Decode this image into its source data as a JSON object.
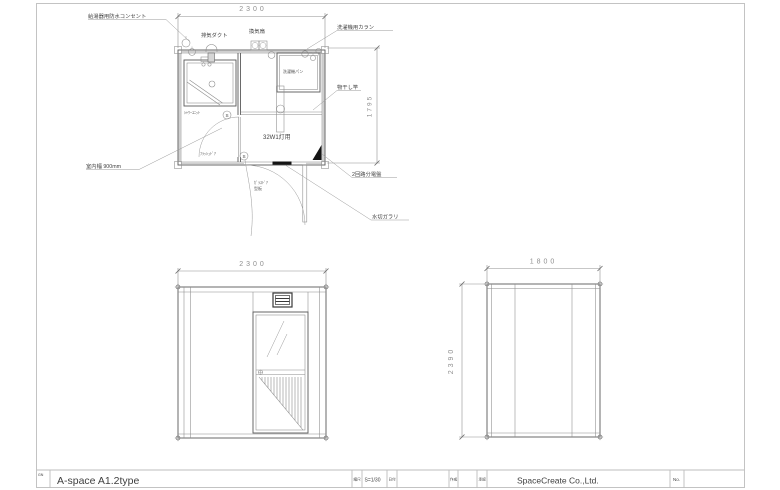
{
  "title_block": {
    "corner_code": "GN",
    "drawing_title": "A-space A1.2type",
    "scale_label": "縮尺",
    "scale_value": "S=1/30",
    "date_label": "日付",
    "drawn_label": "作成",
    "approved_label": "承認",
    "number_label": "No.",
    "company": "SpaceCreate Co.,Ltd."
  },
  "floor_plan": {
    "dim_width": "2300",
    "dim_depth": "1795",
    "labels": {
      "water_heater_outlet": "給湯器用防水コンセント",
      "exhaust_duct": "排気ダクト",
      "vent_fan": "換気扇",
      "washer_faucet": "洗濯機用カラン",
      "washer_pan": "洗濯機パン",
      "drying_pole": "物干し竿",
      "distribution_board": "2回路分電盤",
      "drip_louver": "水切ガラリ",
      "interior_width": "室内幅 900mm",
      "shower_unit": "ｼｬﾜｰﾕﾆｯﾄ",
      "flush_door": "ﾌﾗｯｼｭﾄﾞｱ",
      "glass_door": "ｶﾞﾗｽﾄﾞｱ",
      "glass_type": "型板",
      "light_fixture": "32W1灯用",
      "switch": "S"
    }
  },
  "front_elevation": {
    "dim_width": "2300"
  },
  "side_elevation": {
    "dim_width": "1800",
    "dim_height": "2390"
  }
}
